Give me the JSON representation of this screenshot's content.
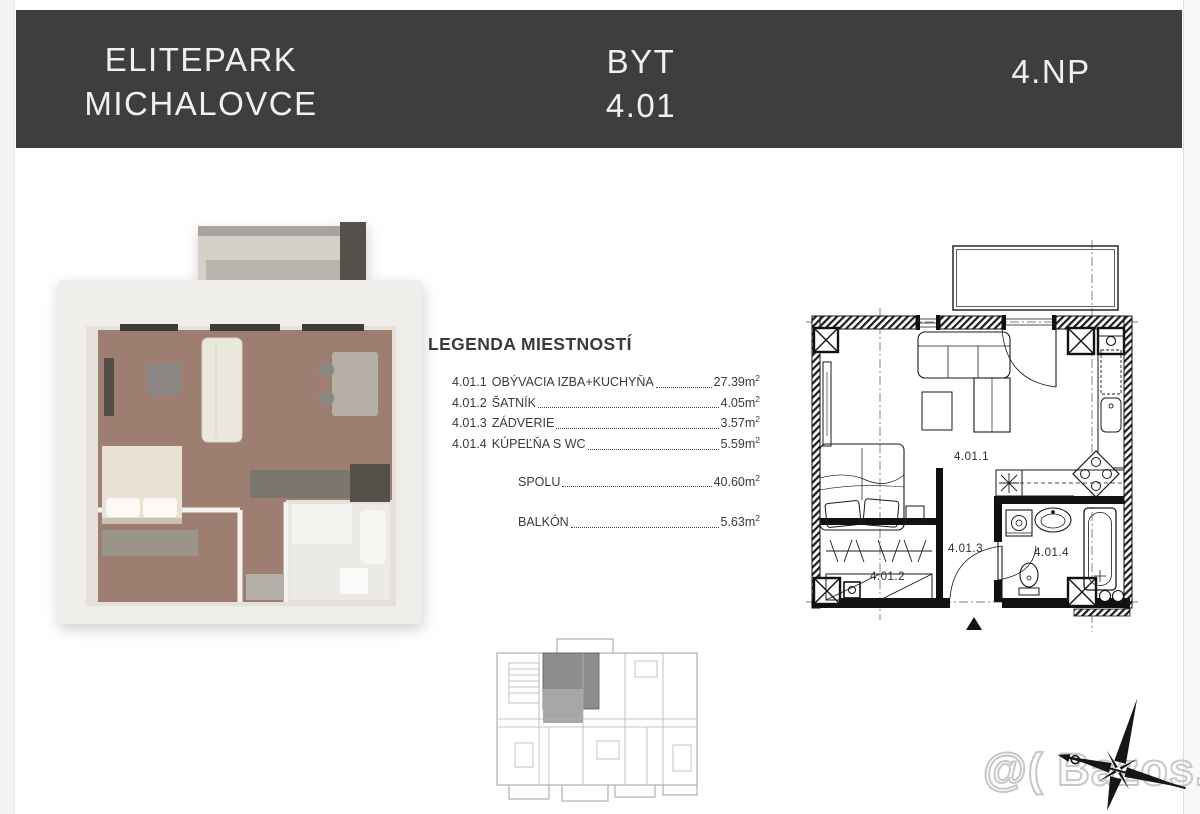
{
  "header": {
    "project_line1": "ELITEPARK",
    "project_line2": "MICHALOVCE",
    "unit_label": "BYT",
    "unit_number": "4.01",
    "floor": "4.NP",
    "bg_color": "#3e3e3e",
    "text_color": "#f1f0f0"
  },
  "legend": {
    "title": "LEGENDA MIESTNOSTÍ",
    "rooms": [
      {
        "code": "4.01.1",
        "name": "OBÝVACIA IZBA+KUCHYŇA",
        "area": "27.39"
      },
      {
        "code": "4.01.2",
        "name": "ŠATNÍK",
        "area": "4.05"
      },
      {
        "code": "4.01.3",
        "name": "ZÁDVERIE",
        "area": "3.57"
      },
      {
        "code": "4.01.4",
        "name": "KÚPEĽŇA S WC",
        "area": "5.59"
      }
    ],
    "total": {
      "label": "SPOLU",
      "area": "40.60"
    },
    "balcony": {
      "label": "BALKÓN",
      "area": "5.63"
    },
    "area_unit": "m",
    "area_sup": "2"
  },
  "floorplan_2d": {
    "labels": {
      "living": "4.01.1",
      "wardrobe": "4.01.2",
      "entry": "4.01.3",
      "bathroom": "4.01.4"
    }
  },
  "watermark": "@( Bazos.sk",
  "colors": {
    "plan_line": "#1a1a1a",
    "floor_wood": "#9d7e70",
    "bathroom_tile": "#eceae6",
    "balcony_gray": "#b8b4ad",
    "keyplan_highlight": "#8d8d8d",
    "watermark_gray": "#c7c7c7"
  }
}
